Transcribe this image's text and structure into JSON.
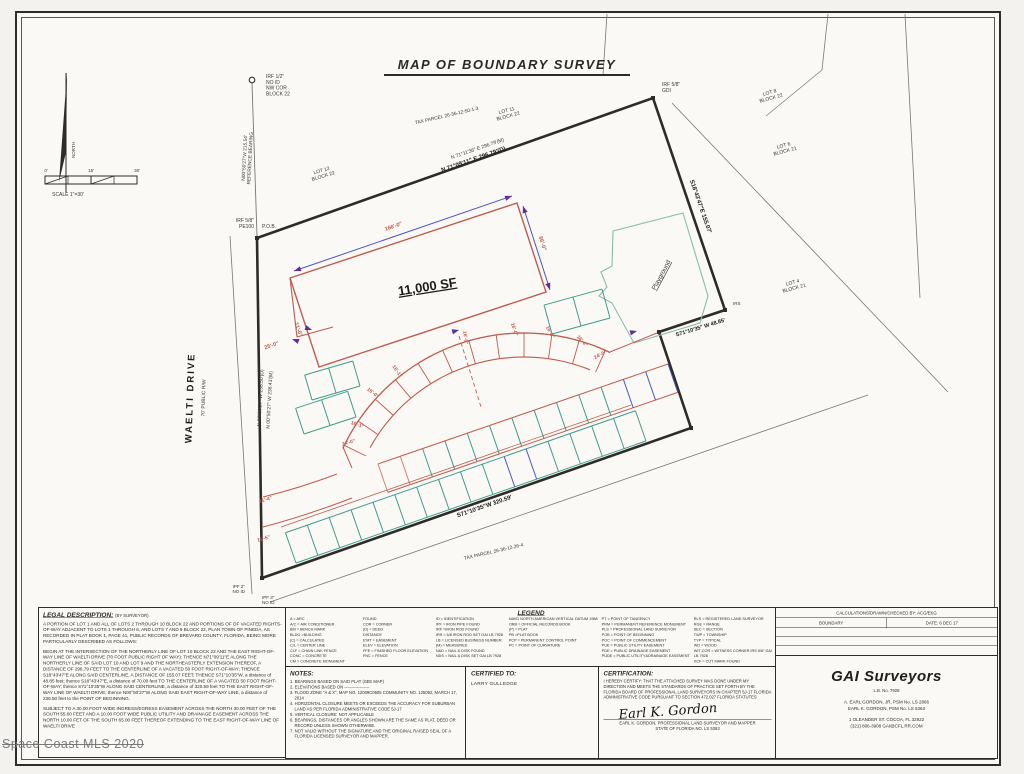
{
  "title": "MAP OF BOUNDARY SURVEY",
  "watermark": "Space Coast MLS 2020",
  "map": {
    "labels": [
      {
        "t": "IRF 1/2\"\nNO ID\nNW COR\nBLOCK 22",
        "x": 266,
        "y": 78,
        "s": 5,
        "a": "start"
      },
      {
        "t": "N00°50'27\"W  215.54'\nREFERENCE BEARING",
        "x": 246,
        "y": 158,
        "r": -87,
        "s": 4.8
      },
      {
        "t": "LOT 12\nBLOCK 22",
        "x": 322,
        "y": 172,
        "r": -17,
        "s": 5
      },
      {
        "t": "TAX PARCEL 26-36-12-50-1-3",
        "x": 447,
        "y": 117,
        "r": -13,
        "s": 4.8
      },
      {
        "t": "LOT 11\nBLOCK 22",
        "x": 507,
        "y": 112,
        "r": -15,
        "s": 5
      },
      {
        "t": "N 71°11'36\" E   296.79'(M)",
        "x": 478,
        "y": 150,
        "r": -19,
        "s": 5
      },
      {
        "t": "N 71°09'11\" E   296.79'(D)",
        "x": 474,
        "y": 161,
        "r": -19,
        "s": 6,
        "c": "b"
      },
      {
        "t": "IRF 5/8\"\nGDI",
        "x": 662,
        "y": 86,
        "s": 5,
        "a": "start"
      },
      {
        "t": "LOT 8\nBLOCK 22",
        "x": 770,
        "y": 94,
        "r": -15,
        "s": 5
      },
      {
        "t": "LOT 6\nBLOCK 21",
        "x": 784,
        "y": 147,
        "r": -15,
        "s": 5
      },
      {
        "t": "LOT 4\nBLOCK 21",
        "x": 793,
        "y": 284,
        "r": -15,
        "s": 5
      },
      {
        "t": "S18°43'47\"E   155.07'",
        "x": 699,
        "y": 207,
        "r": 71,
        "s": 6,
        "c": "b"
      },
      {
        "t": "Playground",
        "x": 663,
        "y": 276,
        "r": -62,
        "s": 6.5,
        "u": 1
      },
      {
        "t": "IRS",
        "x": 733,
        "y": 305,
        "s": 4.5,
        "a": "start"
      },
      {
        "t": "S71°10'35\" W   48.85'",
        "x": 701,
        "y": 329,
        "r": -17,
        "s": 5.5,
        "c": "b"
      },
      {
        "t": "11,000 SF",
        "x": 428,
        "y": 291,
        "r": -9,
        "s": 13,
        "c": "b",
        "u": 1
      },
      {
        "t": "166'-0\"",
        "x": 394,
        "y": 228,
        "r": -19,
        "s": 5.5,
        "c": "r"
      },
      {
        "t": "66'-0\"",
        "x": 541,
        "y": 244,
        "r": 72,
        "s": 5.5,
        "c": "r"
      },
      {
        "t": "25'-0\"",
        "x": 272,
        "y": 347,
        "r": -19,
        "s": 5.5,
        "c": "r"
      },
      {
        "t": "11'-0\"",
        "x": 297,
        "y": 330,
        "r": 70,
        "s": 5.5,
        "c": "r"
      },
      {
        "t": "WAELTI DRIVE",
        "x": 193,
        "y": 398,
        "r": -88,
        "s": 9.5,
        "c": "b",
        "ls": 2
      },
      {
        "t": "70' PUBLIC R/W",
        "x": 205,
        "y": 398,
        "r": -88,
        "s": 5
      },
      {
        "t": "N 00°50'27\" W   236.50'(D)",
        "x": 262,
        "y": 398,
        "r": -87,
        "s": 5
      },
      {
        "t": "N 00°50'27\" W   236.41'(M)",
        "x": 271,
        "y": 400,
        "r": -87,
        "s": 5
      },
      {
        "t": "P.O.B.",
        "x": 262,
        "y": 228,
        "s": 5,
        "a": "start"
      },
      {
        "t": "IRF 5/8\"\nPE100",
        "x": 254,
        "y": 222,
        "s": 5,
        "a": "end"
      },
      {
        "t": "16'-0\"",
        "x": 464,
        "y": 338,
        "r": 82,
        "s": 5,
        "c": "r"
      },
      {
        "t": "16'-0\"",
        "x": 513,
        "y": 330,
        "r": 72,
        "s": 5,
        "c": "r"
      },
      {
        "t": "16'-0\"",
        "x": 549,
        "y": 333,
        "r": 60,
        "s": 5,
        "c": "r"
      },
      {
        "t": "16'-4\"",
        "x": 581,
        "y": 342,
        "r": 48,
        "s": 5,
        "c": "r"
      },
      {
        "t": "24'-0\"",
        "x": 601,
        "y": 356,
        "r": -28,
        "s": 5,
        "c": "r"
      },
      {
        "t": "16'-1\"",
        "x": 396,
        "y": 372,
        "r": 55,
        "s": 5,
        "c": "r"
      },
      {
        "t": "16'-0\"",
        "x": 372,
        "y": 394,
        "r": 38,
        "s": 5,
        "c": "r"
      },
      {
        "t": "16'-1\"",
        "x": 357,
        "y": 426,
        "r": 18,
        "s": 5,
        "c": "r"
      },
      {
        "t": "24'-0\"",
        "x": 349,
        "y": 444,
        "r": -16,
        "s": 5,
        "c": "r"
      },
      {
        "t": "11'-4\"",
        "x": 266,
        "y": 501,
        "r": -15,
        "s": 5,
        "c": "r"
      },
      {
        "t": "11'-5\"",
        "x": 264,
        "y": 540,
        "r": -15,
        "s": 5,
        "c": "r"
      },
      {
        "t": "S71°10'35\"W   320.59'",
        "x": 485,
        "y": 508,
        "r": -19,
        "s": 6,
        "c": "b"
      },
      {
        "t": "TAX PARCEL 26-36-12-26-4",
        "x": 494,
        "y": 553,
        "r": -13,
        "s": 4.8
      },
      {
        "t": "IPF 2\"\nNO ID",
        "x": 245,
        "y": 588,
        "s": 4.5,
        "a": "end"
      },
      {
        "t": "IPF 3\"\nNO ID",
        "x": 262,
        "y": 599,
        "s": 4.5,
        "a": "start"
      },
      {
        "t": "NORTH",
        "x": 75,
        "y": 150,
        "r": -90,
        "s": 4.5
      },
      {
        "t": "0'",
        "x": 46,
        "y": 172,
        "s": 4.5
      },
      {
        "t": "15'",
        "x": 91,
        "y": 172,
        "s": 4.5
      },
      {
        "t": "30'",
        "x": 137,
        "y": 172,
        "s": 4.5
      },
      {
        "t": "SCALE 1\"=30'",
        "x": 68,
        "y": 196,
        "s": 5
      }
    ]
  },
  "legal": {
    "title": "LEGAL DESCRIPTION:",
    "subtitle": "(BY SURVEYOR)",
    "paragraphs": [
      "A PORTION OF LOT 1 AND ALL OF LOTS 2 THROUGH 10 BLOCK 22 AND PORTIONS OF OF VACATED RIGHTS-OF-WAY ADJACENT TO LOTS 1 THROUGH 6, AND LOTS 7 AND 9 BLOCK 22, PLAN TOWN OF PINEDA, AS RECORDED IN PLAT BOOK 1, PAGE 41, PUBLIC RECORDS OF BREVARD COUNTY, FLORIDA, BEING MORE PARTICULARLY DESCRIBED AS FOLLOWS:",
      "BEGIN AT THE INTERSECTION OF THE NORTHERLY LINE OF LOT 10 BLOCK 22 AND THE EAST RIGHT-OF-WAY LINE OF WAELTI DRIVE (70 FOOT PUBLIC RIGHT OF WAY); THENCE N71°09'11\"E ALONG THE NORTHERLY LINE OF SAID LOT 10 AND LOT 9 AND THE NORTHEASTERLY EXTENSION THEREOF, A DISTANCE OF 296.79 FEET TO THE CENTERLINE OF A VACATED 50 FOOT RIGHT-OF-WAY; THENCE S18°43'47\"E ALONG SAID CENTERLINE, A DISTANCE OF 155.07 FEET; THENCE S71°10'35\"W, a distance of 48.85 feet; thence S18°43'47\"E, a distance of 70.00 feet TO THE CENTERLINE OF A VACATED 50 FOOT RIGHT-OF-WAY; thence S71°10'35\"W ALONG SAID CENTERLINE, a distance of 320.59 feet TO THE EAST RIGHT-OF-WAY LINE OF WAELTI DRIVE; thence N00°50'27\"W ALONG SAID EAST RIGHT-OF-WAY LINE, a distance of 236.50 feet to the POINT OF BEGINNING.",
      "SUBJECT TO A 30.00 FOOT WIDE INGRESS/EGRESS EASEMENT ACROSS THE NORTH 30.00 FEET OF THE SOUTH 55.00 FEET AND A 10.00 FOOT WIDE PUBLIC UTILITY AND DRAINAGE EASEMENT ACROSS THE NORTH 10.00 FET OF THE SOUTH 65.00 FEET THEREOF EXTENDING TO THE EAST RIGHT-OF-WAY LINE OF WAELTI DRIVE"
    ]
  },
  "legend": {
    "title": "LEGEND",
    "columns": [
      [
        "A = ARC",
        "A/C = AIR CONDITIONER",
        "BM = BENCH MARK",
        "BLDG =BUILDING",
        "(C) = CALCULATED",
        "C/L = CENTER LINE",
        "CLF = CHAIN LINK FENCE",
        "CONC = CONCRETE",
        "CM = CONCRETE MONUMENT"
      ],
      [
        "FOUND",
        "COR = CORNER",
        "(D) = DEED",
        "DISTANCE",
        "E'MT = EASEMENT",
        "ELEV = ELEVATION",
        "FFE = FINISHED FLOOR ELEVATION",
        "FNC = FENCE"
      ],
      [
        "ID = IDENTIFICATION",
        "IPF = IRON PIPE FOUND",
        "IRF =IRON ROD FOUND",
        "IRS = 5/8 IRON ROD SET GAI LB 7928",
        "LB = LICENSED BUSINESS NUMBER",
        "(M) = MEASURED",
        "N&D = NAIL & DISK FOUND",
        "NDS = NAIL & DISK SET GAI LB 7928"
      ],
      [
        "NAVD NORTH AMERICAN VERTICAL DATUM 1988",
        "ORB = OFFICIAL RECORDS BOOK",
        "(P) = PLAT",
        "PB =PLAT BOOK",
        "PCP = PERMANENT CONTROL POINT",
        "PC = POINT OF CURVATURE"
      ],
      [
        "PT = POINT OF TANGENCY",
        "PRM = PERMANENT REFERENCE MONUMENT",
        "PLS = PROFESSIONAL LAND SURVEYOR",
        "POB = POINT OF BEGINNING",
        "POC = POINT OF COMMENCEMENT",
        "PUE = PUBLIC UTILITY EASEMENT",
        "PDE = PUBLIC DRAINAGE EASEMENT",
        "PUDE = PUBLIC UTILITY&DRAINAGE EASEMENT"
      ],
      [
        "RLS = REGISTERED LAND SURVEYOR",
        "RGE = RANGE",
        "SEC = SECTION",
        "TWP = TOWNSHIP",
        "TYP = TYPICAL",
        "WD = WOOD",
        "WIT-COR = WITNESS CORNER IRS 5/8\" GAI",
        "LB 7928",
        "XCF = CUT MARK FOUND"
      ]
    ]
  },
  "notes": {
    "title": "NOTES:",
    "items": [
      "1. BEARINGS BASED ON SAID PLAT (SEE MAP)",
      "2. ELEVATIONS BASED ON ------------------",
      "3. FLOOD ZONE \"A & X\", MAP NO. 12009C0505 COMMUNITY NO. 125092, MARCH 17, 2014",
      "4. HORIZONTAL CLOSURE MEETS OR EXCEEDS THE ACCURACY FOR SUBURBAN LAND AS PER FLORIDA ADMINISTRATIVE CODE 5J-17",
      "5. VERTICAL CLOSURE: NOT APPLICABLE",
      "6. BEARINGS, DISTANCES OR ANGLES SHOWN ARE THE SAME AS PLAT, DEED OR RECORD UNLESS SHOWN OTHERWISE.",
      "7. NOT VALID WITHOUT THE SIGNATURE AND THE ORIGINAL RAISED SEAL OF A FLORIDA LICENSED SURVEYOR AND MAPPER."
    ]
  },
  "certified": {
    "title": "CERTIFIED TO:",
    "name": "LARRY GULLEDGE"
  },
  "certification": {
    "title": "CERTIFICATION:",
    "body": "I HEREBY CERTIFY: THAT THE ATTACHED SURVEY WAS DONE UNDER MY DIRECTION AND MEETS THE  STANDARDS OF PRACTICE SET FORTH BY THE FLORIDA BOARD OF PROFESSIONAL LAND SURVEYORS IN CHAPTER 5J-17 FLORIDA ADMINISTRATIVE CODE PURSUANT TO SECTION 472.027 FLORIDA STATUTES",
    "signature": "Earl K. Gordon",
    "line1": "EARL K. GORDON, PROFESSIONAL LAND SURVEYOR AND MAPPER",
    "line2": "STATE OF FLORIDA NO. LS 5363"
  },
  "titleblock": {
    "row1": "CALCULATIONS/DRAWN/CHECKED BY: ACG/EKG",
    "type": "BOUNDARY",
    "date": "DATE: 6 DEC 17",
    "firm": "GAI Surveyors",
    "lb": "L.B. No. 7928",
    "surveyor1": "A. EARL GORDON, JR, PSM No. LS 2866",
    "surveyor2": "EARL K. GORDON, PSM No. LS 5363",
    "address": "1 OLEANDER ST. COCOA, FL 32922",
    "phone_email": "(321) 806-3908    GAI@CFL.RR.COM"
  },
  "colors": {
    "ink": "#2e2c29",
    "thin": "#7a776f",
    "red": "#c05a4e",
    "teal": "#3f9c8d",
    "blue": "#4b55c0",
    "purple": "#5d3099",
    "playground": "#8abcac",
    "pink": "#d4826f"
  }
}
